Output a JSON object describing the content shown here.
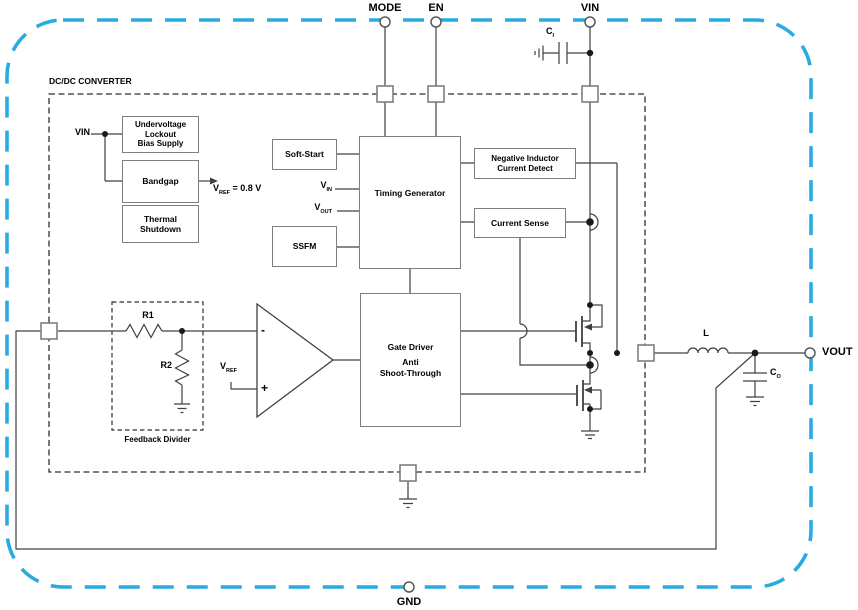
{
  "title": "DC/DC converter functional block diagram",
  "colors": {
    "chip_border_blue": "#29ABE2",
    "box_border_gray": "#7f7f7f",
    "wire": "#404040",
    "text": "#000000",
    "background": "#ffffff"
  },
  "pins": {
    "mode": "MODE",
    "en": "EN",
    "vin": "VIN",
    "vout": "VOUT",
    "gnd": "GND"
  },
  "converter_label": "DC/DC CONVERTER",
  "blocks": {
    "uvlo": [
      "Undervoltage",
      "Lockout",
      "Bias Supply"
    ],
    "bandgap": "Bandgap",
    "thermal": [
      "Thermal",
      "Shutdown"
    ],
    "soft_start": "Soft-Start",
    "timing_generator": "Timing Generator",
    "ssfm": "SSFM",
    "neg_inductor_detect": [
      "Negative Inductor",
      "Current Detect"
    ],
    "current_sense": "Current Sense",
    "gate_driver": [
      "Gate Driver",
      "Anti",
      "Shoot-Through"
    ]
  },
  "labels": {
    "vin_internal": "VIN",
    "vref_eq": {
      "base": "V",
      "sub": "REF",
      "rest": " = 0.8 V"
    },
    "v_in": {
      "base": "V",
      "sub": "IN"
    },
    "v_out": {
      "base": "V",
      "sub": "OUT"
    },
    "v_ref": {
      "base": "V",
      "sub": "REF"
    },
    "c_in": {
      "base": "C",
      "sub": "I"
    },
    "c_out": {
      "base": "C",
      "sub": "O"
    },
    "inductor": "L",
    "r1": "R1",
    "r2": "R2",
    "feedback_divider": "Feedback Divider",
    "comparator_minus": "-",
    "comparator_plus": "+"
  }
}
